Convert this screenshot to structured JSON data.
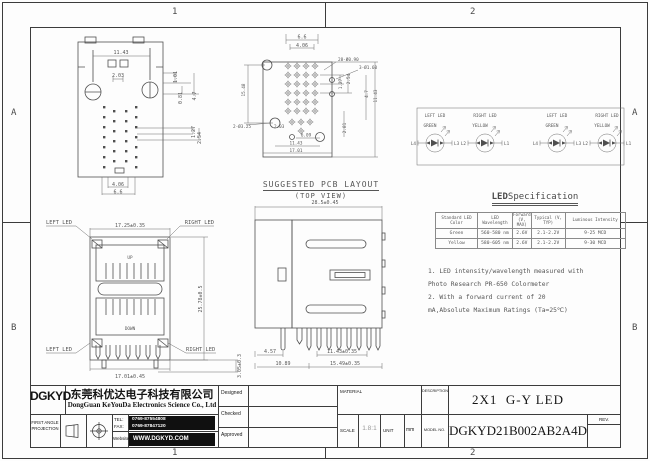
{
  "zones": {
    "top_1": "1",
    "top_2": "2",
    "bottom_1": "1",
    "bottom_2": "2",
    "left_a": "A",
    "left_b": "B",
    "right_a": "A",
    "right_b": "B"
  },
  "front_view": {
    "dim_width": "11.43",
    "dim_2_03": "2.03",
    "dim_1_01": "1.01",
    "dim_0_81": "0.81",
    "dim_4_7": "4.7",
    "dim_1_27": "1.27",
    "dim_2_54": "2.54",
    "dim_4_06": "4.06",
    "dim_6_6": "6.6"
  },
  "pcb": {
    "title": "SUGGESTED PCB LAYOUT",
    "subtitle": "(TOP VIEW)",
    "dim_6_6": "6.6",
    "dim_4_06": "4.06",
    "holes_pins": "28-Ø0.90",
    "holes_led": "3-Ø1.60",
    "dim_15_48": "15.48",
    "holes_mount": "2-Ø3.25",
    "dim_2_03": "2.03",
    "dim_6_09": "6.09",
    "dim_11_43": "11.43",
    "dim_17_01": "17.01",
    "dim_1_27": "1.27",
    "dim_2_54": "2.54",
    "dim_4_7": "4.7",
    "dim_11_43_r": "11.43",
    "dim_2_81": "2.81"
  },
  "led_circuits": {
    "items": [
      {
        "position": "LEFT LED",
        "color": "GREEN",
        "pin_left": "L4",
        "pin_right": "L3"
      },
      {
        "position": "RIGHT LED",
        "color": "YELLOW",
        "pin_left": "L2",
        "pin_right": "L1"
      },
      {
        "position": "LEFT LED",
        "color": "GREEN",
        "pin_left": "L4",
        "pin_right": "L3"
      },
      {
        "position": "RIGHT LED",
        "color": "YELLOW",
        "pin_left": "L2",
        "pin_right": "L1"
      }
    ]
  },
  "led_spec": {
    "title_lead": "LED",
    "title_rest": " Specification",
    "headers": [
      "Standard LED Color",
      "LED Wavelength",
      "Forward (V, MAX)",
      "Typical (V, TYP)",
      "Luminous Intensity"
    ],
    "rows": [
      [
        "Green",
        "560-580 nm",
        "2.6V",
        "2.1-2.2V",
        "9-25 MCD"
      ],
      [
        "Yellow",
        "580-605 nm",
        "2.6V",
        "2.1-2.2V",
        "9-30 MCD"
      ]
    ]
  },
  "notes": {
    "line1": "1. LED intensity/wavelength measured with",
    "line2": "Photo Research PR-650 Colormeter",
    "line3": "2. With a forward current of 20",
    "line4": "mA,Absolute Maximum Ratings (Ta=25℃)"
  },
  "stacked_view": {
    "label_top_left": "LEFT LED",
    "label_top_right": "RIGHT LED",
    "label_bottom_left": "LEFT LED",
    "label_bottom_right": "RIGHT LED",
    "dim_width_top": "17.25±0.35",
    "dim_height": "25.78±0.5",
    "dim_width_bottom": "17.01±0.45",
    "dim_leg": "3.05±0.3",
    "port_top": "UP",
    "port_bottom": "DOWN"
  },
  "side_view": {
    "dim_depth": "28.5±0.45",
    "dim_4_57": "4.57",
    "dim_11_43": "11.43±0.35",
    "dim_10_89": "10.89",
    "dim_15_49": "15.49±0.35"
  },
  "title_block": {
    "logo": "DGKYD",
    "company_cn": "东莞科优达电子科技有限公司",
    "company_en": "DongGuan KeYouDa Electronics Science Co., Ltd",
    "projection_line1": "FIRST ANGLE",
    "projection_line2": "PROJECTION",
    "tel_label": "TEL:",
    "fax_label": "FAX:",
    "tel": "0769-87554808",
    "fax": "0769-87847120",
    "website_label": "Website",
    "website": "WWW.DGKYD.COM",
    "designed": "Designed",
    "checked": "Checked",
    "approved": "Approved",
    "material": "MATERIAL",
    "description": "DESCRIPTION",
    "title": "2X1  G-Y LED",
    "scale_label": "SCALE",
    "scale": "1.8:1",
    "unit_label": "UNIT",
    "unit": "mm",
    "model_label": "MODEL NO.",
    "model": "DGKYD21B002AB2A4D",
    "rev_label": "REV."
  }
}
